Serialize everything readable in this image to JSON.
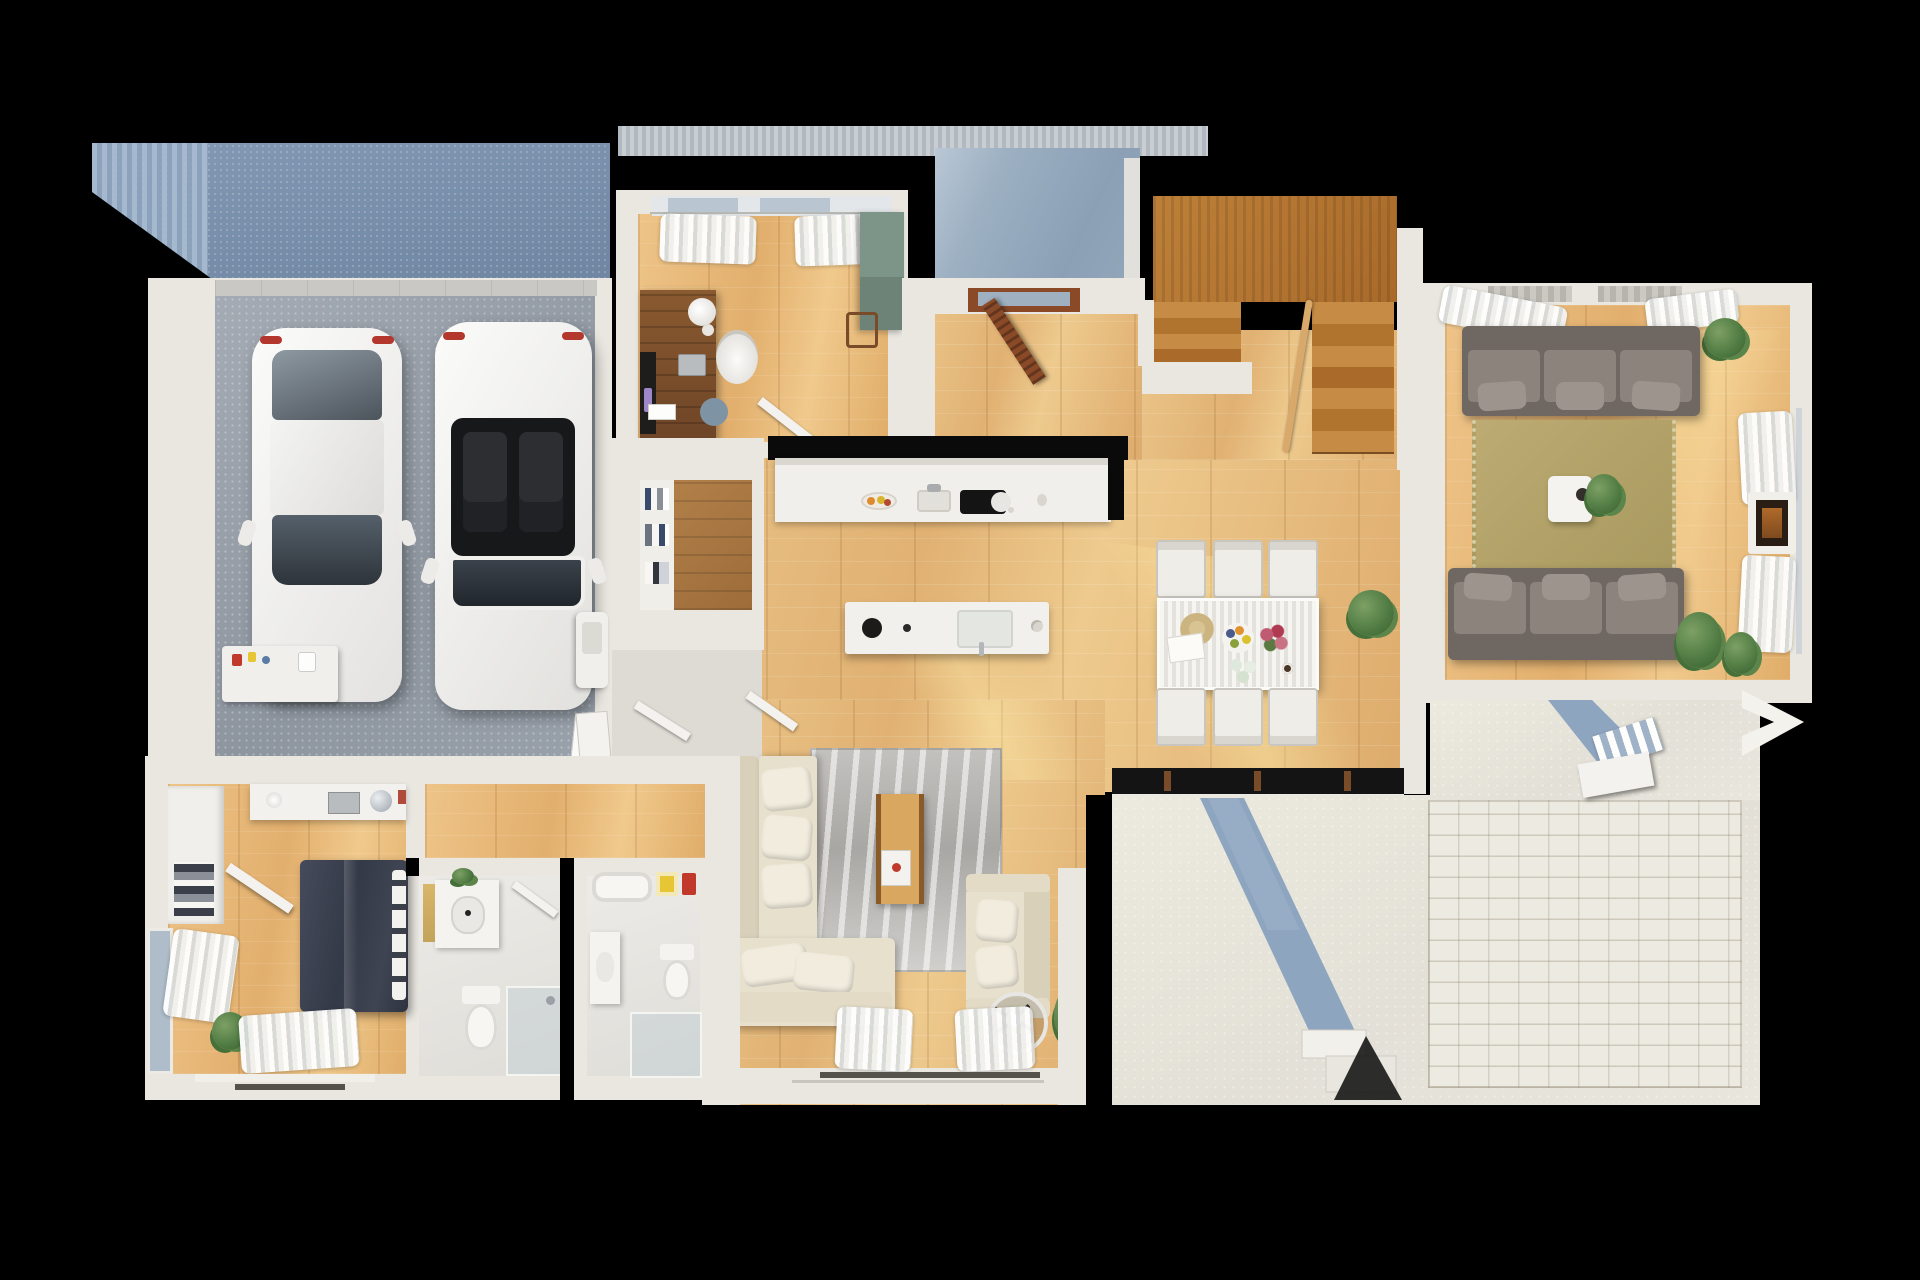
{
  "scene": {
    "type": "floor-plan",
    "style": "photorealistic 3D top-down render, first floor",
    "background_color": "#000000",
    "image_size": {
      "width": 1920,
      "height": 1280
    },
    "text_visible": false
  },
  "palette": {
    "background": "#000000",
    "wall": "#eae7e1",
    "wood_floor": "#e2b478",
    "dark_wood": "#8a5a30",
    "stairs_wood": "#b5792f",
    "garage_floor": "#99a1ab",
    "deck_blue": "#7b90ab",
    "porch_blue": "#93a7bb",
    "patio_concrete": "#e7e4db",
    "brick_paving": "#edeae1",
    "path_blue": "#8ea5c0",
    "living_rug_olive": "#b3a268",
    "family_rug_grey": "#cfccc8",
    "sofa_grey": "#8c847c",
    "sofa_beige": "#e7e0cd",
    "bed_navy": "#3c4150",
    "counter_white": "#f0efec",
    "cabinet_green": "#7d9488",
    "accent_red": "#c0392b",
    "accent_yellow": "#e6c635"
  },
  "rooms": [
    {
      "name": "deck",
      "position": "top-left",
      "surface": "blue composite decking"
    },
    {
      "name": "garage",
      "position": "left",
      "contents": [
        "white-sedan",
        "white-convertible",
        "workbench",
        "utility-sink",
        "leaning-canvases"
      ],
      "car_count": 2
    },
    {
      "name": "office",
      "position": "top-center-left",
      "contents": [
        "desk",
        "desk-lamp",
        "laptop",
        "office-chair",
        "blue-pouf",
        "green-cabinet",
        "stool",
        "window-curtains"
      ]
    },
    {
      "name": "entry-porch",
      "position": "top-center",
      "surface": "blue-grey concrete",
      "contents": [
        "open-front-door"
      ]
    },
    {
      "name": "staircase",
      "position": "top-center-right",
      "contents": [
        "landing",
        "left-flight",
        "right-flight",
        "railing"
      ],
      "flights": 2
    },
    {
      "name": "living-room",
      "position": "right",
      "contents": [
        "grey-sofa-top",
        "grey-sofa-bottom",
        "olive-rug",
        "coffee-table",
        "plants",
        "fireplace",
        "window-curtains"
      ]
    },
    {
      "name": "kitchen",
      "position": "center",
      "contents": [
        "counter-run",
        "fruit-bowl",
        "sink",
        "cooktop-with-pan",
        "island",
        "island-sink",
        "pot"
      ]
    },
    {
      "name": "pantry",
      "position": "center-left",
      "contents": [
        "shelving"
      ]
    },
    {
      "name": "mudroom-hall",
      "position": "center-left",
      "contents": [
        "open-door"
      ]
    },
    {
      "name": "dining-area",
      "position": "center-right",
      "contents": [
        "ribbed-white-table",
        "six-chairs",
        "sun-hat",
        "fruit-plate",
        "flowers",
        "glasses",
        "plant"
      ],
      "chair_count": 6
    },
    {
      "name": "family-room",
      "position": "bottom-center",
      "contents": [
        "beige-sectional",
        "beige-loveseat",
        "grey-marble-rug",
        "media-console",
        "fan-wheel",
        "plant",
        "window-curtains"
      ]
    },
    {
      "name": "bedroom",
      "position": "bottom-left",
      "contents": [
        "navy-bed",
        "white-pillows",
        "wardrobe",
        "desk-with-disco-ball",
        "plant",
        "window-curtains"
      ]
    },
    {
      "name": "bathroom-a",
      "position": "bottom-center-left",
      "contents": [
        "vanity-sink",
        "round-mirror",
        "toilet",
        "glass-shower",
        "open-door"
      ]
    },
    {
      "name": "bathroom-b",
      "position": "bottom-center-left-2",
      "contents": [
        "bathtub",
        "yellow-mirror",
        "red-towel",
        "vanity",
        "toilet",
        "glass-shower"
      ]
    },
    {
      "name": "patio",
      "position": "bottom-right",
      "surface": "light concrete + paver bricks",
      "contents": [
        "blue-walkway-a",
        "blue-walkway-b",
        "outdoor-steps",
        "edge-step-chevron"
      ]
    }
  ]
}
